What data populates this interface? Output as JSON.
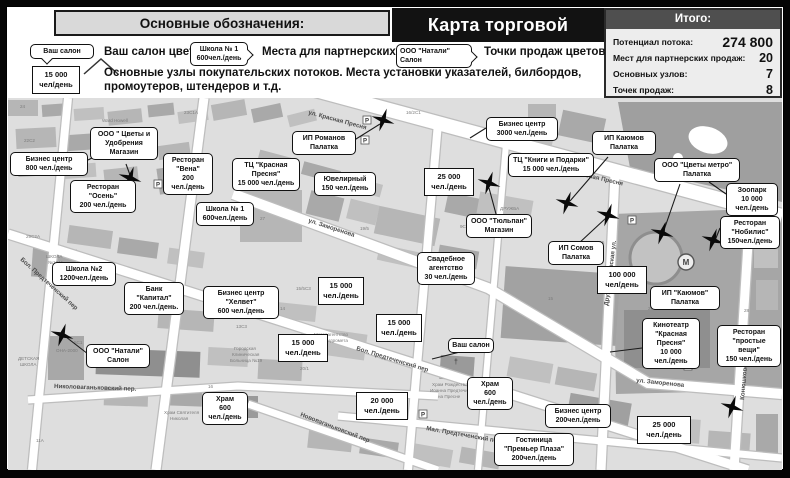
{
  "header": {
    "legend_title": "Основные обозначения:",
    "map_title": "Карта торговой территории",
    "legend": {
      "salon_sample": "Ваш салон",
      "salon_label": "Ваш салон цветов",
      "partner_sample": [
        "Школа № 1",
        "600чел./день"
      ],
      "partner_label": "Места для партнерских продаж",
      "node_sample": [
        "15 000",
        "чел/день"
      ],
      "node_label": "Основные узлы покупательских потоков. Места установки указателей, билбордов, промоутеров, штендеров и т.д.",
      "pos_sample": [
        "ООО \"Натали\"",
        "Салон"
      ],
      "pos_label": "Точки продаж цветов"
    },
    "totals": {
      "title": "Итого:",
      "rows": [
        {
          "label": "Потенциал потока:",
          "value": "274 800"
        },
        {
          "label": "Мест для партнерских продаж:",
          "value": "20"
        },
        {
          "label": "Основных узлов:",
          "value": "7"
        },
        {
          "label": "Точек продаж:",
          "value": "8"
        }
      ]
    }
  },
  "map": {
    "colors": {
      "callout_border": "#111111",
      "star": "#0a0a0a",
      "street": "#ffffff",
      "base": "#dedede"
    },
    "streets": [
      {
        "n": "ул. Красная Пресня",
        "x": 300,
        "y": 16,
        "r": 15
      },
      {
        "n": "ул. Красная Пресня",
        "x": 556,
        "y": 74,
        "r": 13
      },
      {
        "n": "ул. Заморенова",
        "x": 300,
        "y": 124,
        "r": 18
      },
      {
        "n": "ул. Заморенова",
        "x": 628,
        "y": 284,
        "r": 6
      },
      {
        "n": "Бол. Предтеченский пер",
        "x": 12,
        "y": 162,
        "r": 42
      },
      {
        "n": "Бол. Предтеченский пер",
        "x": 348,
        "y": 252,
        "r": 17
      },
      {
        "n": "Николоваганьковский пер.",
        "x": 46,
        "y": 290,
        "r": 2
      },
      {
        "n": "Нововаганьковский пер",
        "x": 292,
        "y": 318,
        "r": 21
      },
      {
        "n": "Мал. Предтеченский пер",
        "x": 418,
        "y": 332,
        "r": 10
      },
      {
        "n": "Дружинниковская ул.",
        "x": 600,
        "y": 208,
        "r": -83
      },
      {
        "n": "Конюшковская ул.",
        "x": 736,
        "y": 302,
        "r": -85
      }
    ],
    "callouts": [
      {
        "type": "callout",
        "x": 2,
        "y": 54,
        "w": 78,
        "lines": [
          "Бизнес центр",
          "800 чел./день"
        ]
      },
      {
        "type": "callout",
        "x": 82,
        "y": 29,
        "w": 68,
        "lines": [
          "ООО \" Цветы и",
          "Удобрения",
          "Магазин"
        ]
      },
      {
        "type": "callout",
        "x": 62,
        "y": 82,
        "w": 66,
        "lines": [
          "Ресторан",
          "\"Осень\"",
          "200 чел./день"
        ]
      },
      {
        "type": "callout",
        "x": 155,
        "y": 55,
        "w": 50,
        "lines": [
          "Ресторан",
          "\"Вена\"",
          "200",
          "чел./день"
        ]
      },
      {
        "type": "callout",
        "x": 224,
        "y": 60,
        "w": 68,
        "lines": [
          "ТЦ \"Красная",
          "Пресня\"",
          "15 000 чел./день"
        ]
      },
      {
        "type": "callout",
        "x": 188,
        "y": 104,
        "w": 58,
        "lines": [
          "Школа № 1",
          "600чел./день"
        ]
      },
      {
        "type": "callout",
        "x": 44,
        "y": 164,
        "w": 64,
        "lines": [
          "Школа №2",
          "1200чел./день"
        ]
      },
      {
        "type": "callout",
        "x": 116,
        "y": 184,
        "w": 60,
        "lines": [
          "Банк",
          "\"Капитал\"",
          "200 чел./день."
        ]
      },
      {
        "type": "callout",
        "x": 195,
        "y": 188,
        "w": 76,
        "lines": [
          "Бизнес центр",
          "\"Хелвет\"",
          "600 чел./день"
        ]
      },
      {
        "type": "callout",
        "x": 78,
        "y": 246,
        "w": 64,
        "lines": [
          "ООО \"Натали\"",
          "Салон"
        ]
      },
      {
        "type": "callout",
        "x": 194,
        "y": 294,
        "w": 46,
        "lines": [
          "Храм",
          "600",
          "чел./день"
        ]
      },
      {
        "type": "node",
        "x": 416,
        "y": 70,
        "w": 50,
        "lines": [
          "25 000",
          "чел./день"
        ]
      },
      {
        "type": "node",
        "x": 310,
        "y": 179,
        "w": 46,
        "lines": [
          "15 000",
          "чел./день"
        ]
      },
      {
        "type": "node",
        "x": 368,
        "y": 216,
        "w": 46,
        "lines": [
          "15 000",
          "чел./день"
        ]
      },
      {
        "type": "node",
        "x": 270,
        "y": 236,
        "w": 50,
        "lines": [
          "15 000",
          "чел./день"
        ]
      },
      {
        "type": "node",
        "x": 348,
        "y": 294,
        "w": 52,
        "lines": [
          "20 000",
          "чел./день"
        ]
      },
      {
        "type": "node",
        "x": 589,
        "y": 168,
        "w": 50,
        "lines": [
          "100 000",
          "чел/день"
        ]
      },
      {
        "type": "node",
        "x": 629,
        "y": 318,
        "w": 54,
        "lines": [
          "25 000",
          "чел./день"
        ]
      },
      {
        "type": "callout",
        "x": 440,
        "y": 240,
        "w": 46,
        "lines": [
          "Ваш салон"
        ]
      },
      {
        "type": "callout",
        "x": 459,
        "y": 279,
        "w": 46,
        "lines": [
          "Храм",
          "600",
          "чел./день"
        ]
      },
      {
        "type": "callout",
        "x": 486,
        "y": 335,
        "w": 80,
        "lines": [
          "Гостиница",
          "\"Премьер Плаза\"",
          "200чел./день"
        ]
      },
      {
        "type": "callout",
        "x": 537,
        "y": 306,
        "w": 66,
        "lines": [
          "Бизнес центр",
          "200чел./день"
        ]
      },
      {
        "type": "callout",
        "x": 409,
        "y": 154,
        "w": 58,
        "lines": [
          "Свадебное",
          "агентство",
          "30 чел./день"
        ]
      },
      {
        "type": "callout",
        "x": 458,
        "y": 116,
        "w": 66,
        "lines": [
          "ООО \"Тюльпан\"",
          "Магазин"
        ]
      },
      {
        "type": "callout",
        "x": 540,
        "y": 143,
        "w": 56,
        "lines": [
          "ИП Сомов",
          "Палатка"
        ]
      },
      {
        "type": "callout",
        "x": 284,
        "y": 33,
        "w": 64,
        "lines": [
          "ИП Романов",
          "Палатка"
        ]
      },
      {
        "type": "callout",
        "x": 306,
        "y": 74,
        "w": 62,
        "lines": [
          "Ювелирный",
          "150 чел./день"
        ]
      },
      {
        "type": "callout",
        "x": 478,
        "y": 19,
        "w": 72,
        "lines": [
          "Бизнес центр",
          "3000 чел./день"
        ]
      },
      {
        "type": "callout",
        "x": 500,
        "y": 55,
        "w": 86,
        "lines": [
          "ТЦ \"Книги и Подарки\"",
          "15 000 чел./день"
        ]
      },
      {
        "type": "callout",
        "x": 584,
        "y": 33,
        "w": 64,
        "lines": [
          "ИП Каюмов",
          "Палатка"
        ]
      },
      {
        "type": "callout",
        "x": 646,
        "y": 60,
        "w": 86,
        "lines": [
          "ООО \"Цветы метро\"",
          "Палатка"
        ]
      },
      {
        "type": "callout",
        "x": 718,
        "y": 85,
        "w": 52,
        "lines": [
          "Зоопарк",
          "10 000",
          "чел./день"
        ]
      },
      {
        "type": "callout",
        "x": 712,
        "y": 118,
        "w": 60,
        "lines": [
          "Ресторан",
          "\"Нобилис\"",
          "150чел./день"
        ]
      },
      {
        "type": "callout",
        "x": 642,
        "y": 188,
        "w": 70,
        "lines": [
          "ИП \"Каюмов\"",
          "Палатка"
        ]
      },
      {
        "type": "callout",
        "x": 634,
        "y": 220,
        "w": 58,
        "lines": [
          "Кинотеатр",
          "\"Красная",
          "Пресня\"",
          "10 000",
          "чел./день"
        ]
      },
      {
        "type": "callout",
        "x": 709,
        "y": 227,
        "w": 64,
        "lines": [
          "Ресторан",
          "\"простые вещи\"",
          "150 чел./день"
        ]
      }
    ],
    "stars": [
      [
        375,
        22
      ],
      [
        122,
        80
      ],
      [
        481,
        85
      ],
      [
        559,
        105
      ],
      [
        600,
        117
      ],
      [
        654,
        135
      ],
      [
        705,
        142
      ],
      [
        54,
        237
      ],
      [
        724,
        309
      ]
    ],
    "small_labels": [
      {
        "t": "ДРУЖБА",
        "x": 492,
        "y": 112
      },
      {
        "t": "Ward Howell",
        "x": 94,
        "y": 24
      },
      {
        "t": "ОНА-2000",
        "x": 48,
        "y": 254
      },
      {
        "t": "Метеоагентство",
        "x": 306,
        "y": 238
      },
      {
        "t": "Росгидромета",
        "x": 310,
        "y": 244
      },
      {
        "t": "ШКОЛА",
        "x": 38,
        "y": 160
      },
      {
        "t": "№1241",
        "x": 40,
        "y": 166
      },
      {
        "t": "ДЕТСКАЯ",
        "x": 10,
        "y": 262
      },
      {
        "t": "ШКОЛА",
        "x": 12,
        "y": 268
      },
      {
        "t": "Храм Святителя",
        "x": 156,
        "y": 316
      },
      {
        "t": "Николая",
        "x": 162,
        "y": 322
      },
      {
        "t": "Храм Рождества",
        "x": 424,
        "y": 288
      },
      {
        "t": "Иоанна Предтечи",
        "x": 422,
        "y": 294
      },
      {
        "t": "на Пресне",
        "x": 430,
        "y": 300
      },
      {
        "t": "Городская",
        "x": 226,
        "y": 252
      },
      {
        "t": "Клиническая",
        "x": 224,
        "y": 258
      },
      {
        "t": "Больница №19",
        "x": 222,
        "y": 264
      },
      {
        "t": "24",
        "x": 12,
        "y": 10
      },
      {
        "t": "23С1А",
        "x": 176,
        "y": 16
      },
      {
        "t": "16/2С1",
        "x": 398,
        "y": 16
      },
      {
        "t": "27",
        "x": 252,
        "y": 122
      },
      {
        "t": "19/5",
        "x": 352,
        "y": 132
      },
      {
        "t": "9С4",
        "x": 452,
        "y": 130
      },
      {
        "t": "15",
        "x": 540,
        "y": 202
      },
      {
        "t": "14",
        "x": 272,
        "y": 212
      },
      {
        "t": "16",
        "x": 200,
        "y": 290
      },
      {
        "t": "29С1",
        "x": 640,
        "y": 212
      },
      {
        "t": "13С3",
        "x": 228,
        "y": 230
      },
      {
        "t": "15/5С3",
        "x": 288,
        "y": 192
      },
      {
        "t": "20/1",
        "x": 292,
        "y": 272
      },
      {
        "t": "11А",
        "x": 28,
        "y": 344
      },
      {
        "t": "5С1",
        "x": 66,
        "y": 246
      },
      {
        "t": "28",
        "x": 736,
        "y": 214
      },
      {
        "t": "1С5",
        "x": 588,
        "y": 146
      },
      {
        "t": "22С2",
        "x": 16,
        "y": 44
      },
      {
        "t": "29С2А",
        "x": 18,
        "y": 140
      }
    ]
  }
}
